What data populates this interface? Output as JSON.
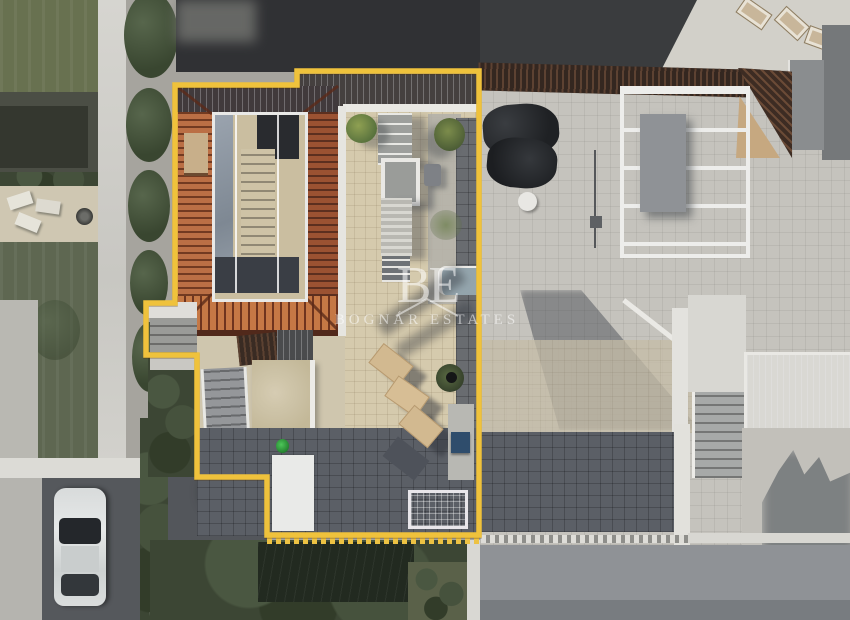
{
  "watermark": {
    "monogram": "BE",
    "name": "BOGNÁR ESTATES"
  },
  "colors": {
    "outline": "#EFC23C",
    "watermark": "rgba(255,255,255,0.55)",
    "roof-tile": "#BE6E42",
    "roof-ridge": "#5E2B18",
    "terrace-beige": "#D6CAAB",
    "patio-dark": "#5B5F66",
    "paving-light": "#C5C3BD",
    "lawn-green": "#68714F",
    "hedge-green": "#3C4633",
    "storage-white": "#E9EAE8",
    "watering-can-green": "#2EA23C",
    "pool-box-blue": "#2E4D6E"
  }
}
